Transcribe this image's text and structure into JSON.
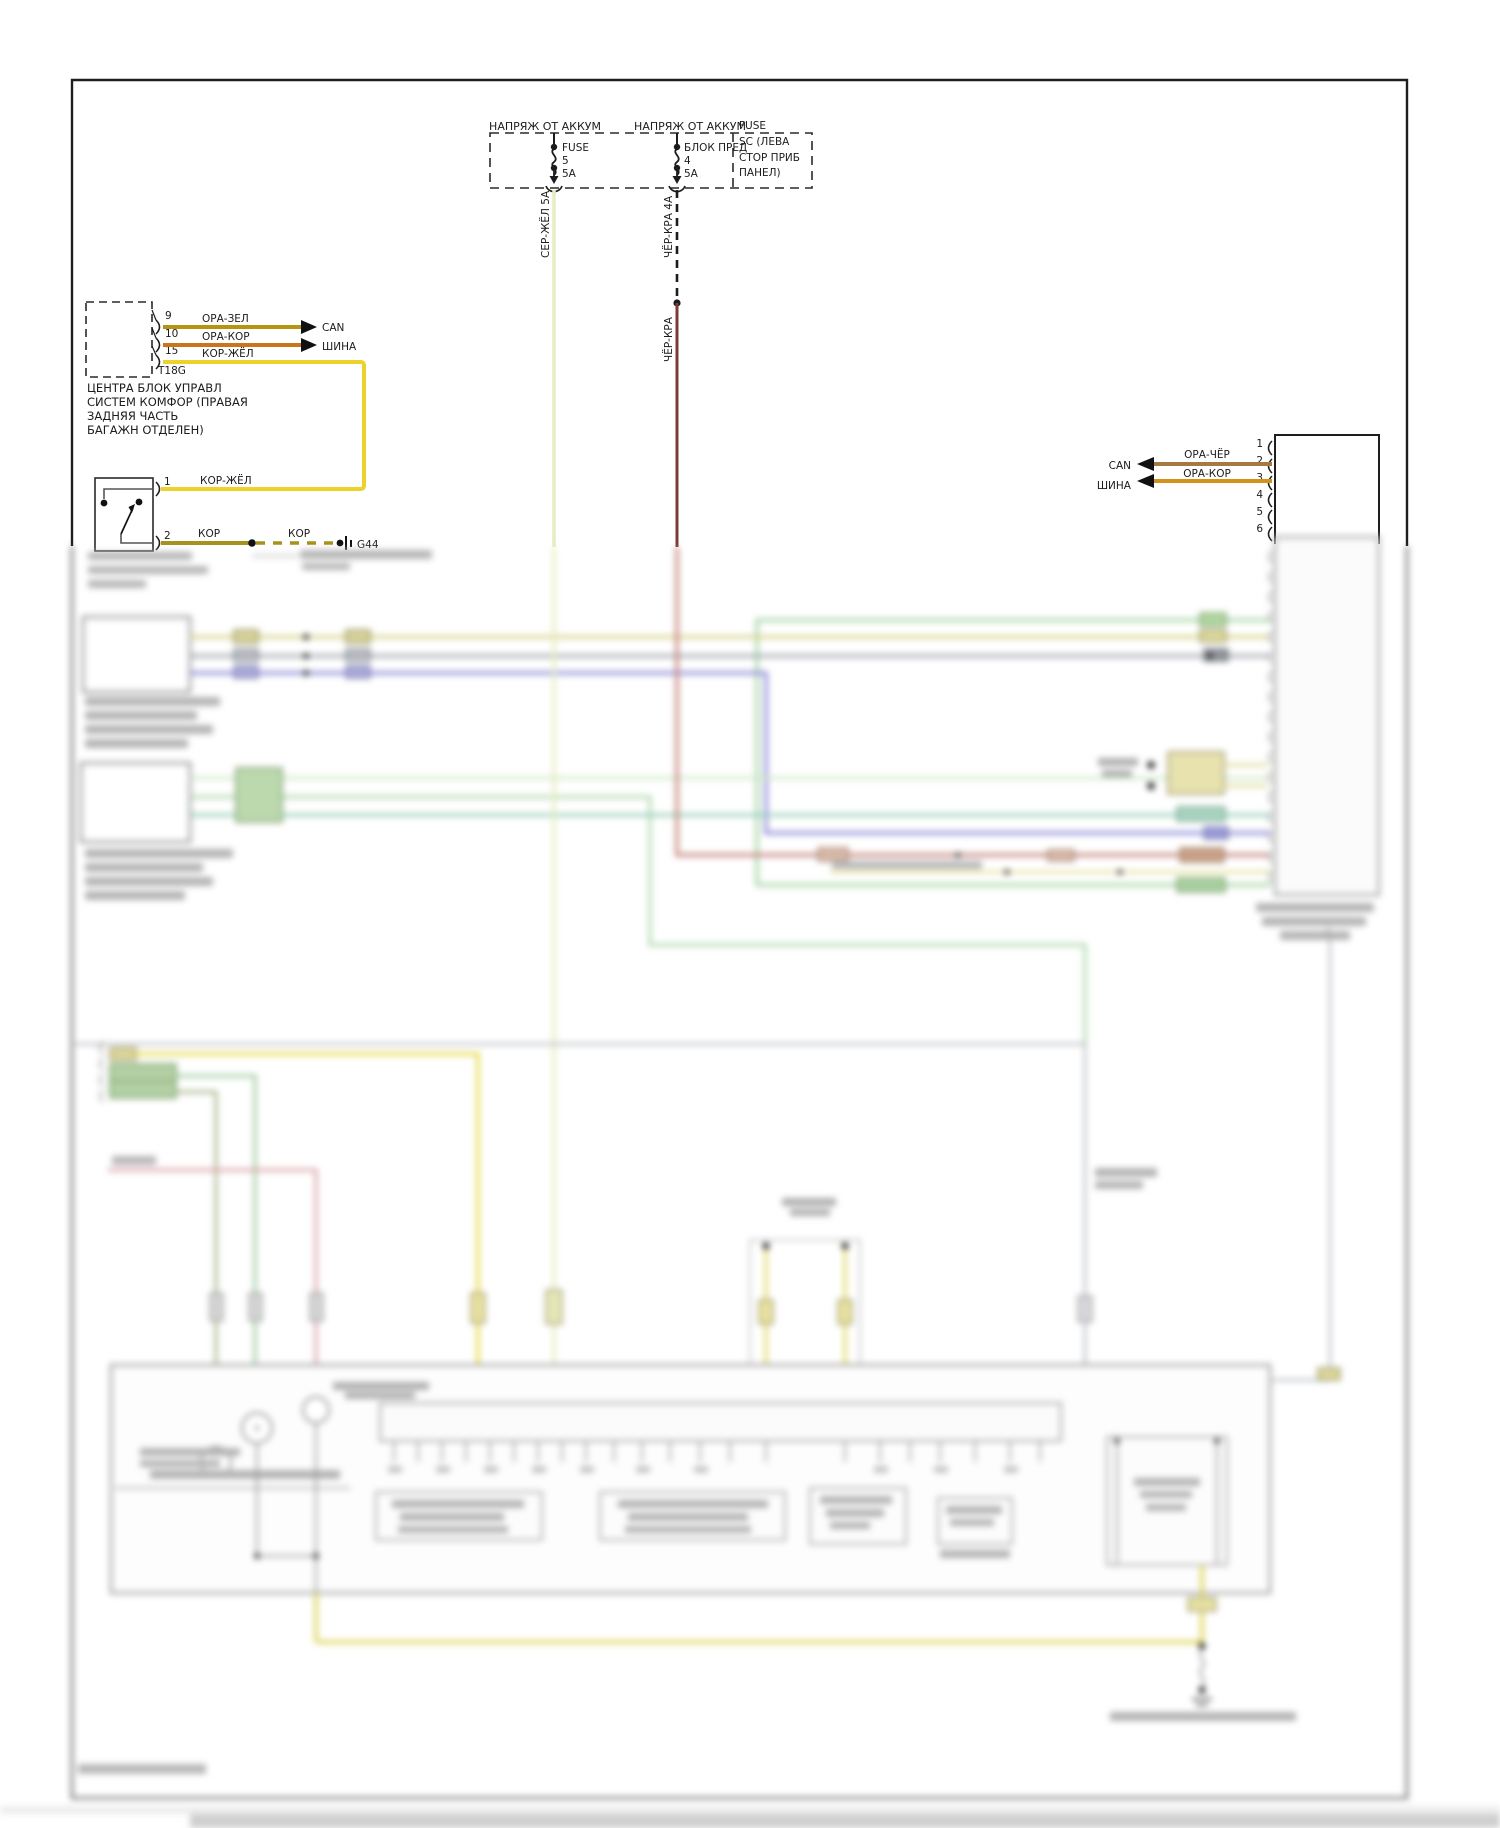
{
  "feeds": {
    "label": "НАПРЯЖ ОТ АККУМ"
  },
  "fuse1": {
    "name": "FUSE",
    "num": "5",
    "amp": "5А"
  },
  "fuse2": {
    "name": "БЛОК ПРЕД",
    "num": "4",
    "amp": "5А",
    "note": [
      "FUSE",
      "SC (ЛЕВА",
      "СТОР ПРИБ",
      "ПАНЕЛ)"
    ]
  },
  "wires": {
    "ser_zhel": "СЕР-ЖЁЛ 5А",
    "cher_kra_4a": "ЧЁР-КРА 4А",
    "cher_kra": "ЧЁР-КРА"
  },
  "bus": {
    "can": "CAN",
    "shina": "ШИНА"
  },
  "t18g": {
    "id": "T18G",
    "pins": [
      {
        "num": "9",
        "color": "ОРА-ЗЕЛ"
      },
      {
        "num": "10",
        "color": "ОРА-КОР"
      },
      {
        "num": "15",
        "color": "КОР-ЖЁЛ"
      }
    ],
    "caption": [
      "ЦЕНТРА БЛОК УПРАВЛ",
      "СИСТЕМ КОМФОР (ПРАВАЯ",
      "ЗАДНЯЯ ЧАСТЬ",
      "БАГАЖН ОТДЕЛЕН)"
    ]
  },
  "switch": {
    "pin1": "1",
    "pin1_color": "КОР-ЖЁЛ",
    "pin2": "2",
    "pin2_color": "КОР",
    "pin2_color2": "КОР",
    "ground": "G44"
  },
  "right_connector": {
    "pins": [
      "1",
      "2",
      "3",
      "4",
      "5",
      "6"
    ],
    "wire2_color": "ОРА-ЧЁР",
    "wire3_color": "ОРА-КОР"
  },
  "colors": {
    "ser_zhel_wire": "#e7ecc2",
    "cher_kra_wire": "#7a3c36",
    "ora_zel_wire": "#b5950f",
    "ora_kor_wire": "#c8761c",
    "kor_zhel_wire": "#ecd22a",
    "kor_wire": "#a6921f",
    "ora_cher_wire": "#a5793f",
    "ora_kor_right_wire": "#d0941e",
    "blur_yellow": "#d9d48e",
    "blur_grey": "#a7abb2",
    "blur_blue": "#8f8fd9",
    "blur_green": "#9ccf9c",
    "blur_teal": "#8fcbb4",
    "blur_red": "#c4857c"
  }
}
